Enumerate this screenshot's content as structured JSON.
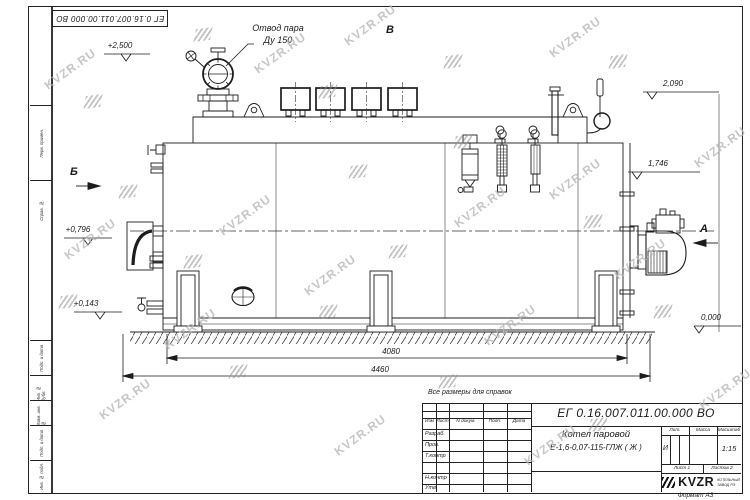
{
  "sheet": {
    "doc_number": "ЕГ 0.16.007.011.00.000  ВО",
    "reference_note": "Все размеры для справок",
    "format_label": "Формат А3"
  },
  "watermark": {
    "text": "KVZR.RU"
  },
  "margin_labels": [
    "Перв. примен.",
    "Справ. №",
    "Подп. и дата",
    "Инв. № дубл.",
    "Взам. инв. №",
    "Подп. и дата",
    "Инв. № подл."
  ],
  "views": {
    "a": "А",
    "b": "Б",
    "v": "В"
  },
  "callouts": {
    "steam_outlet_line1": "Отвод пара",
    "steam_outlet_line2": "Ду 150"
  },
  "levels": {
    "l2500": "+2,500",
    "l2090": "2,090",
    "l1746": "1,746",
    "l0796": "+0,796",
    "l0143": "+0,143",
    "l0000": "0,000"
  },
  "dimensions": {
    "supports_span": "4080",
    "overall_length": "4460"
  },
  "title_block": {
    "doc_number": "ЕГ 0.16.007.011.00.000  ВО",
    "product_name_line1": "Котел паровой",
    "product_name_line2": "Е-1,6-0,07-115-ГЛЖ ( Ж )",
    "header": {
      "izm": "Изм",
      "list": "Лист",
      "n_doc": "N докум.",
      "podp": "Подп.",
      "data": "Дата"
    },
    "rows": [
      "Разраб.",
      "Пров.",
      "Т.контр",
      "",
      "Н.контр",
      "Утв."
    ],
    "lit_label": "Лит.",
    "mass_label": "Масса",
    "scale_label": "Масштаб",
    "lit_value": "И",
    "scale_value": "1:15",
    "sheet_label": "Лист  1",
    "sheets_label": "Листов  2",
    "brand": "KVZR",
    "brand_line1": "КОТЕЛЬНЫЙ",
    "brand_line2": "ЗАВОД РЭ"
  }
}
